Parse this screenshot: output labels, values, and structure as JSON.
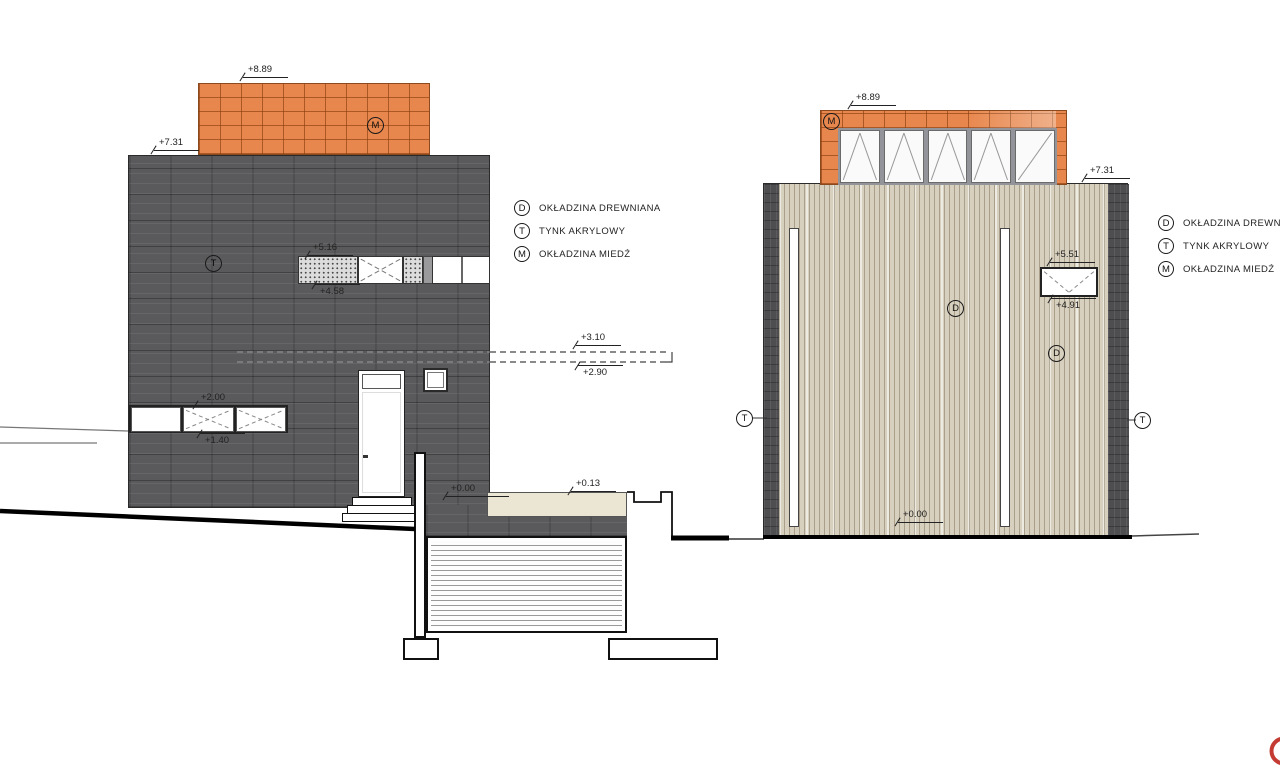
{
  "drawing": {
    "legend": {
      "items": [
        {
          "symbol": "D",
          "label": "OKŁADZINA DREWNIANA"
        },
        {
          "symbol": "T",
          "label": "TYNK AKRYLOWY"
        },
        {
          "symbol": "M",
          "label": "OKŁADZINA MIEDŹ"
        }
      ]
    },
    "left_elevation": {
      "marks": {
        "top": "+8.89",
        "roof": "+7.31",
        "band_top": "+5.16",
        "band_bottom": "+4.58",
        "slab_top": "+3.10",
        "slab_bottom": "+2.90",
        "window_top": "+2.00",
        "window_bottom": "+1.40",
        "ground": "+0.00"
      },
      "symbols": {
        "copper": "M",
        "plaster": "T"
      }
    },
    "section": {
      "marks": {
        "slab": "+0.13"
      }
    },
    "right_elevation": {
      "marks": {
        "top": "+8.89",
        "roof": "+7.31",
        "window_top": "+5.51",
        "window_bottom": "+4.91",
        "ground": "+0.00"
      },
      "symbols": {
        "copper": "M",
        "wood_left": "D",
        "wood_right": "D",
        "plaster_left": "T",
        "plaster_right": "T"
      }
    },
    "colors": {
      "copper": "#E8874D",
      "dark_cladding": "#59595B",
      "wood_cladding": "#D8D0BF",
      "logo_red": "#C43B33"
    }
  }
}
